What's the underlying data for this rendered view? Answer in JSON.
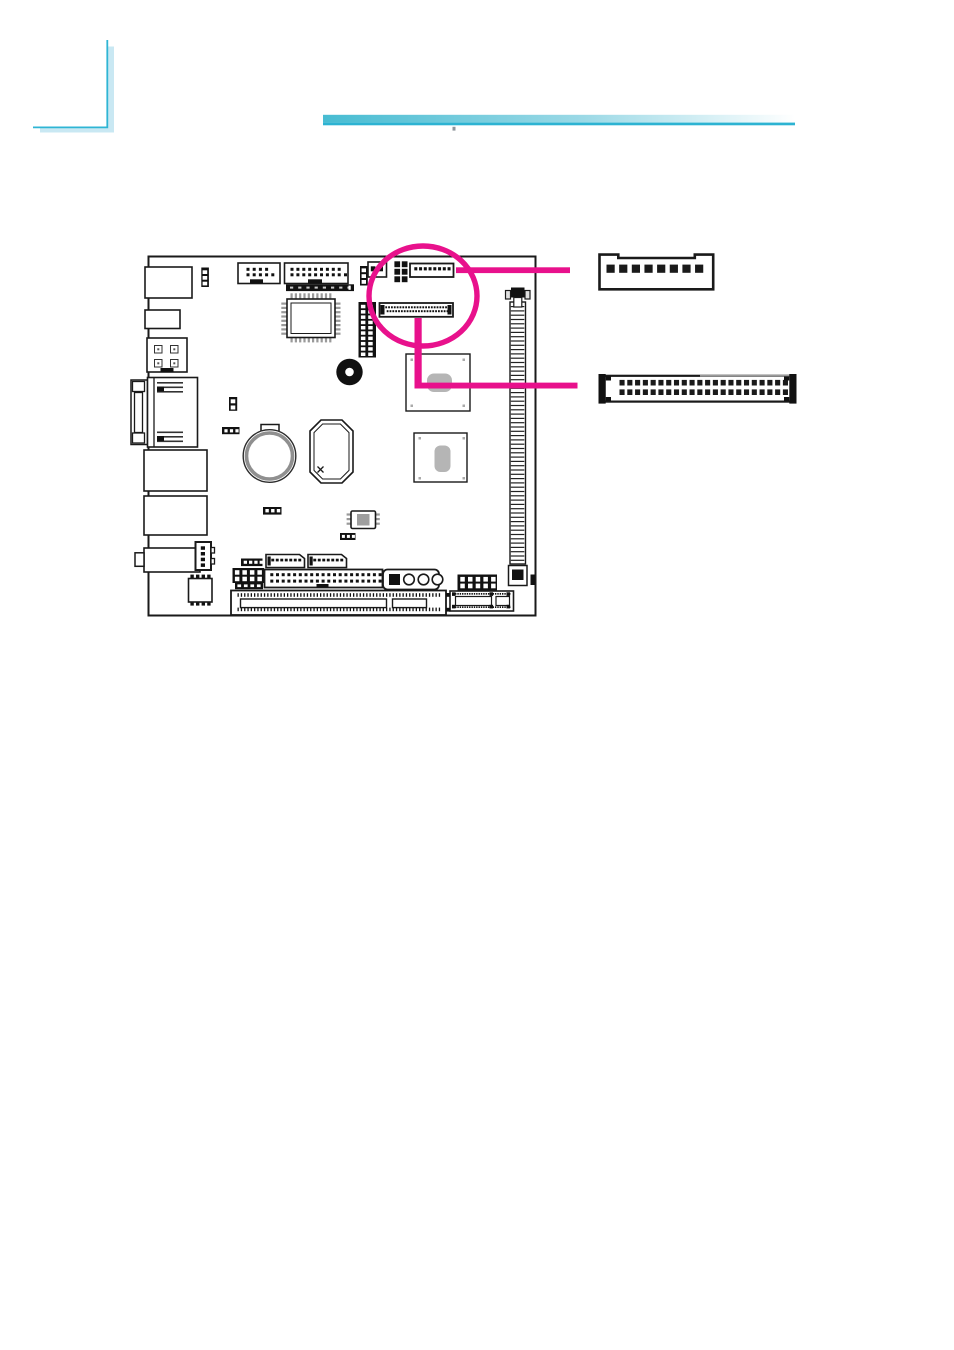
{
  "colors": {
    "highlight": "#E8118C",
    "line_art": "#1a1a1a",
    "chip_pad_gray": "#b5b5b5",
    "pin_gray": "#9a9a9a",
    "corner_line": "#2FB5D4",
    "corner_shadow": "#C9E8F3",
    "rule_start": "#47BCD2",
    "rule_mid": "#9BD9E6",
    "rule_end": "#FFFFFF",
    "rule_underline": "#2DB3D2",
    "page_bg": "#FFFFFF"
  },
  "figure": {
    "kind": "motherboard connector-location diagram",
    "highlight": {
      "shape": "circle-with-leader-lines",
      "targets": [
        "8-pin wafer connector",
        "44-pin box header"
      ]
    },
    "illustrations": [
      {
        "id": "connector-8pin-wafer",
        "rows": 1,
        "pins_shown": 8
      },
      {
        "id": "connector-44pin-box-header",
        "rows": 2,
        "pins_shown": 44
      }
    ],
    "board_components": [
      "io-port-block",
      "jumper-3pin",
      "front-panel-header",
      "multi-pin-header",
      "flat-cable-footprint",
      "qfp-chip",
      "power-connector-4pin",
      "vga-db15-port",
      "lan-port",
      "usb-port-block",
      "audio-port-block",
      "fan-connector",
      "jumper-2pin",
      "battery",
      "buzzer",
      "cpu-socket",
      "chipset-north",
      "chipset-south",
      "dimm-socket",
      "vertical-pin-header-2x10",
      "highlighted-8pin-connector",
      "highlighted-44pin-connector",
      "crystal-oscillator",
      "super-io-chip",
      "com-port-header-1",
      "com-port-header-2",
      "pin-header-2x4",
      "pin-header-2x5",
      "ide-connector",
      "front-audio-block",
      "pci-slot",
      "mini-card-connector"
    ]
  },
  "pin_arrays": {
    "jmp3a": {
      "count": 1,
      "x": 202.6,
      "y": 270.3,
      "rows": 3,
      "rdy": 5.7,
      "w": 4.6,
      "h": 3.7,
      "fill": "#ffffff"
    },
    "power_pins": {
      "count": 2,
      "dx": 16,
      "x": 154.5,
      "y": 345.5,
      "rows": 2,
      "rdy": 14,
      "w": 7.5,
      "h": 7.5,
      "fill": "#ffffff",
      "s": "#333333",
      "sw": 1
    },
    "power_dots": {
      "count": 2,
      "dx": 16,
      "x": 157.3,
      "y": 348.3,
      "rows": 2,
      "rdy": 14,
      "w": 2,
      "h": 2,
      "fill": "#555555"
    },
    "vga_top": {
      "count": 1,
      "x": 157,
      "y": 382,
      "rows": 3,
      "rdy": 4.5,
      "w": 26,
      "h": 1.6,
      "fill": "#333333"
    },
    "vga_bottom": {
      "count": 1,
      "x": 157,
      "y": 431.5,
      "rows": 3,
      "rdy": 4.5,
      "w": 26,
      "h": 1.6,
      "fill": "#333333"
    },
    "fan_pins": {
      "count": 1,
      "x": 200.8,
      "y": 546.3,
      "rows": 4,
      "rdy": 5.7,
      "w": 4.2,
      "h": 3.5,
      "fill": "#111111"
    },
    "hdr1_dots": {
      "count": 4,
      "dx": 6.2,
      "x": 246.5,
      "y": 267.8,
      "rows": 2,
      "rdy": 5.5,
      "w": 3,
      "h": 3,
      "fill": "#111111"
    },
    "hdr1_extra": {
      "count": 1,
      "x": 271.3,
      "y": 273.3,
      "w": 3,
      "h": 3,
      "fill": "#111111"
    },
    "hdr2_dots": {
      "count": 9,
      "dx": 5.9,
      "x": 290.5,
      "y": 267.8,
      "rows": 2,
      "rdy": 5.5,
      "w": 3,
      "h": 3,
      "fill": "#111111"
    },
    "hdr2_extra": {
      "count": 1,
      "x": 344,
      "y": 273.3,
      "w": 3,
      "h": 3,
      "fill": "#111111"
    },
    "lvdsfp_dashes": {
      "count": 8,
      "dx": 8.2,
      "x": 290,
      "y": 286.6,
      "w": 3.2,
      "h": 2,
      "fill": "#c9c9c9"
    },
    "qfp_top": {
      "count": 10,
      "dx": 4.3,
      "x": 290.5,
      "y": 293.3,
      "w": 2.2,
      "h": 5.2,
      "fill": "#9a9a9a"
    },
    "qfp_bottom": {
      "count": 10,
      "dx": 4.3,
      "x": 290.5,
      "y": 337.2,
      "w": 2.2,
      "h": 5.2,
      "fill": "#9a9a9a"
    },
    "qfp_left": {
      "count": 8,
      "dy": 4.3,
      "x": 281.3,
      "y": 302.5,
      "w": 5.2,
      "h": 2.2,
      "fill": "#9a9a9a"
    },
    "qfp_right": {
      "count": 8,
      "dy": 4.3,
      "x": 335.3,
      "y": 302.5,
      "w": 5.2,
      "h": 2.2,
      "fill": "#9a9a9a"
    },
    "jmp2": {
      "count": 1,
      "x": 230.7,
      "y": 399.3,
      "rows": 2,
      "rdy": 6.2,
      "w": 4.6,
      "h": 4,
      "fill": "#ffffff"
    },
    "jmpdots_a": {
      "count": 3,
      "dx": 5.5,
      "x": 224.4,
      "y": 429.2,
      "w": 3.2,
      "h": 3.2,
      "fill": "#ffffff"
    },
    "jmp3b": {
      "count": 1,
      "x": 361.6,
      "y": 268.4,
      "rows": 3,
      "rdy": 5.8,
      "w": 4.4,
      "h": 3.8,
      "fill": "#ffffff"
    },
    "dualdot": {
      "count": 2,
      "dx": 7.6,
      "x": 370.8,
      "y": 266.3,
      "w": 4.6,
      "h": 5,
      "fill": "#111111"
    },
    "block2x3": {
      "count": 2,
      "dx": 7.4,
      "x": 394.4,
      "y": 261.3,
      "rows": 3,
      "rdy": 7.5,
      "w": 5.7,
      "h": 5.9,
      "fill": "#111111"
    },
    "conn8_dashes": {
      "count": 8,
      "dx": 4.75,
      "x": 414.3,
      "y": 267.2,
      "w": 3,
      "h": 3.2,
      "fill": "#111111"
    },
    "lvds_r1": {
      "count": 23,
      "dx": 2.85,
      "x": 385.3,
      "y": 306.3,
      "w": 1.8,
      "h": 2,
      "fill": "#111111"
    },
    "lvds_r2": {
      "count": 22,
      "dx": 2.85,
      "x": 386.7,
      "y": 310.2,
      "w": 1.8,
      "h": 2,
      "fill": "#111111"
    },
    "vh210": {
      "count": 2,
      "dx": 7.3,
      "x": 360.9,
      "y": 304.8,
      "rows": 10,
      "rdy": 5.3,
      "w": 4.5,
      "h": 3.5,
      "fill": "#ffffff"
    },
    "dimm_rungs": {
      "count": 1,
      "x": 510.8,
      "y": 306,
      "rows": 60,
      "rdy": 4.3,
      "w": 13.5,
      "h": 1.2,
      "fill": "#222222"
    },
    "chip1_marks": {
      "count": 2,
      "dx": 52,
      "x": 410.5,
      "y": 358.5,
      "rows": 2,
      "rdy": 46,
      "w": 2.5,
      "h": 2.5,
      "fill": "#aaaaaa"
    },
    "chip2_marks": {
      "count": 2,
      "dx": 44,
      "x": 418.5,
      "y": 437,
      "rows": 2,
      "rdy": 40,
      "w": 2.5,
      "h": 2.5,
      "fill": "#aaaaaa"
    },
    "crystal_l": {
      "count": 1,
      "x": 346.6,
      "y": 513.4,
      "rows": 3,
      "rdy": 4.6,
      "w": 4.2,
      "h": 2.2,
      "fill": "#9a9a9a"
    },
    "crystal_r": {
      "count": 1,
      "x": 375.6,
      "y": 513.4,
      "rows": 3,
      "rdy": 4.6,
      "w": 4.2,
      "h": 2.2,
      "fill": "#9a9a9a"
    },
    "jmpdots_b": {
      "count": 3,
      "dx": 5.7,
      "x": 265.4,
      "y": 509,
      "w": 3.4,
      "h": 3.4,
      "fill": "#ffffff"
    },
    "jmpdots_c": {
      "count": 3,
      "dx": 5,
      "x": 341.9,
      "y": 534.9,
      "w": 3,
      "h": 3,
      "fill": "#ffffff"
    },
    "superio_top": {
      "count": 4,
      "dx": 5.6,
      "x": 190.4,
      "y": 574.6,
      "w": 3.4,
      "h": 4,
      "fill": "#111111"
    },
    "superio_bot": {
      "count": 4,
      "dx": 5.6,
      "x": 190.4,
      "y": 601.6,
      "w": 3.4,
      "h": 4,
      "fill": "#111111"
    },
    "bar4a": {
      "count": 4,
      "dx": 5.3,
      "x": 243.7,
      "y": 560.7,
      "w": 3.3,
      "h": 3.1,
      "fill": "#ffffff"
    },
    "com1_dashes": {
      "count": 7,
      "dx": 4.5,
      "x": 271.3,
      "y": 558.7,
      "w": 2.9,
      "h": 2.7,
      "fill": "#111111"
    },
    "com2_dashes": {
      "count": 7,
      "dx": 4.5,
      "x": 313.3,
      "y": 558.7,
      "w": 2.9,
      "h": 2.7,
      "fill": "#111111"
    },
    "hdr2x4": {
      "count": 4,
      "dx": 7.5,
      "x": 234.9,
      "y": 570.2,
      "rows": 2,
      "rdy": 6.5,
      "w": 4.5,
      "h": 4.5,
      "fill": "#ffffff"
    },
    "bar4b": {
      "count": 4,
      "dx": 6.5,
      "x": 237.4,
      "y": 584.4,
      "w": 3.7,
      "h": 2.7,
      "fill": "#ffffff"
    },
    "ide_r1": {
      "count": 20,
      "dx": 5.7,
      "x": 270.3,
      "y": 573.2,
      "w": 3,
      "h": 3,
      "fill": "#111111"
    },
    "ide_r2": {
      "count": 20,
      "dx": 5.7,
      "x": 270.3,
      "y": 579.6,
      "w": 3,
      "h": 3,
      "fill": "#111111"
    },
    "hdr2x5": {
      "count": 5,
      "dx": 7.7,
      "x": 460.3,
      "y": 576.9,
      "rows": 2,
      "rdy": 6.7,
      "w": 4.5,
      "h": 4.7,
      "fill": "#ffffff"
    },
    "mini_top": {
      "count": 24,
      "dx": 2.35,
      "x": 455,
      "y": 593,
      "w": 1.4,
      "h": 1.7,
      "fill": "#111111"
    },
    "mini_bot": {
      "count": 24,
      "dx": 2.35,
      "x": 455,
      "y": 606.3,
      "w": 1.4,
      "h": 1.7,
      "fill": "#111111"
    },
    "pci_ticks_t": {
      "count": 62,
      "dx": 3.3,
      "x": 237.5,
      "y": 593.2,
      "w": 1.3,
      "h": 3.6,
      "fill": "#111111"
    },
    "pci_ticks_b": {
      "count": 62,
      "dx": 3.3,
      "x": 237.5,
      "y": 607.6,
      "w": 1.3,
      "h": 3.6,
      "fill": "#111111"
    },
    "illus1_pins": {
      "count": 8,
      "dx": 12.65,
      "x": 606.5,
      "y": 264.6,
      "w": 8.2,
      "h": 8.2,
      "fill": "#1a1a1a"
    },
    "illus2_r1": {
      "count": 22,
      "dx": 7.78,
      "x": 619.5,
      "y": 379.9,
      "w": 5.1,
      "h": 5.6,
      "fill": "#1a1a1a"
    },
    "illus2_r2": {
      "count": 22,
      "dx": 7.78,
      "x": 619.5,
      "y": 389.4,
      "w": 5.1,
      "h": 5.6,
      "fill": "#1a1a1a"
    }
  }
}
